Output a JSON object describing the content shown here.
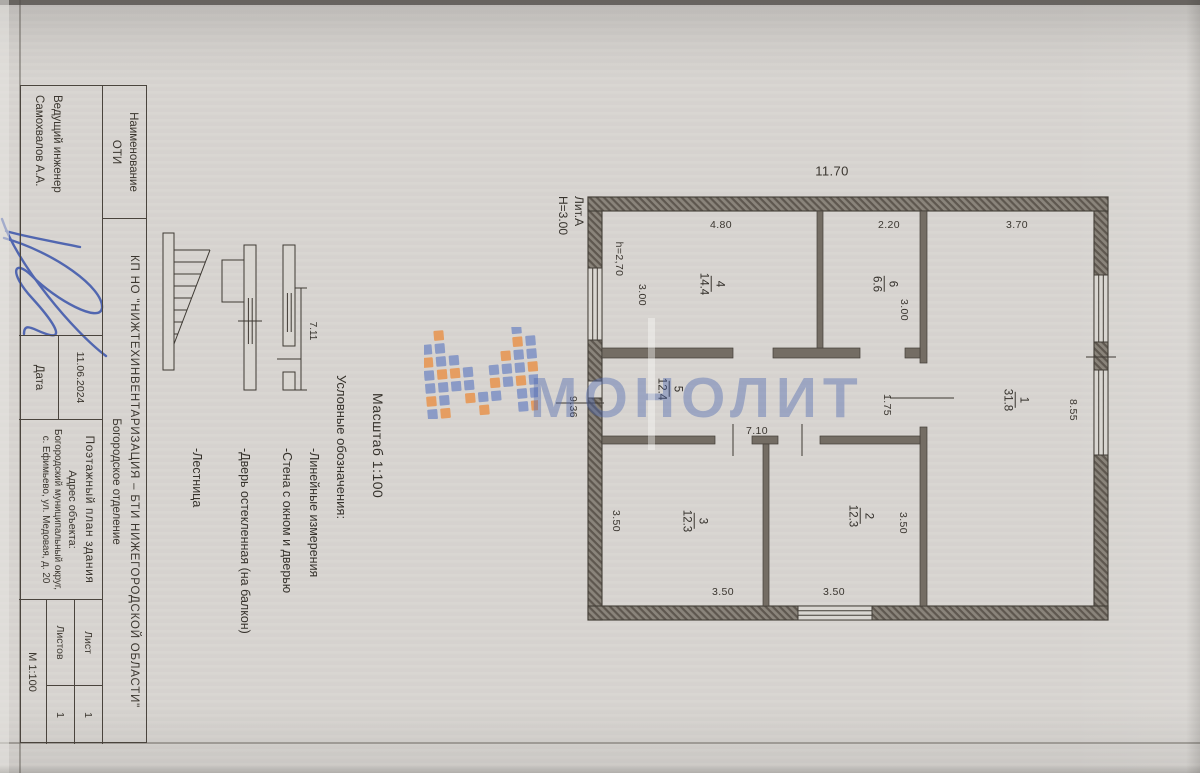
{
  "theme": {
    "wm-blue": "#7e91c5",
    "wm-orange": "#e8944e",
    "wm-text": "#4e68b0",
    "sig-blue": "#3f58ac"
  },
  "watermark": {
    "text": "МОНОЛИТ"
  },
  "plan": {
    "building_label": "Лит.А",
    "building_height": "Н=3.00",
    "rooms": [
      {
        "number": "1",
        "area": "31.8"
      },
      {
        "number": "6",
        "area": "6.6"
      },
      {
        "number": "2",
        "area": "12.3"
      },
      {
        "number": "4",
        "area": "14.4"
      },
      {
        "number": "3",
        "area": "12.3"
      },
      {
        "number": "5",
        "area": "12.4"
      }
    ],
    "dims": [
      "11.70",
      "3.70",
      "8.55",
      "2.20",
      "3.00",
      "1.75",
      "3.50",
      "3.50",
      "4.80",
      "7.10",
      "3.50",
      "3.50",
      "3.00",
      "h=2,70",
      "9.36"
    ]
  },
  "legend": {
    "scale": "Масштаб 1:100",
    "heading": "Условные обозначения:",
    "sample_value": "7.11",
    "items": [
      "-Линейные измерения",
      "-Стена с окном и дверью",
      "-Дверь остекленная (на балкон)",
      "-Лестница"
    ]
  },
  "title_block": {
    "name_line1": "Наименование",
    "name_line2": "ОТИ",
    "org_line1": "КП НО \"НИЖТЕХИНВЕНТАРИЗАЦИЯ – БТИ НИЖЕГОРОДСКОЙ ОБЛАСТИ\"",
    "org_line2": "Богородское отделение",
    "engineer_role": "Ведущий инженер",
    "engineer_name": "Самохвалов А.А.",
    "date_value": "11.06.2024",
    "date_label": "Дата",
    "doc_title": "Поэтажный план здания",
    "address_label": "Адрес объекта:",
    "address_line1": "Богородский муниципальный округ,",
    "address_line2": "с. Ефимьево, ул. Медовая, д. 20",
    "sheet_label": "Лист",
    "sheet_value": "1",
    "sheets_label": "Листов",
    "sheets_value": "1",
    "scale_value": "М 1:100"
  }
}
